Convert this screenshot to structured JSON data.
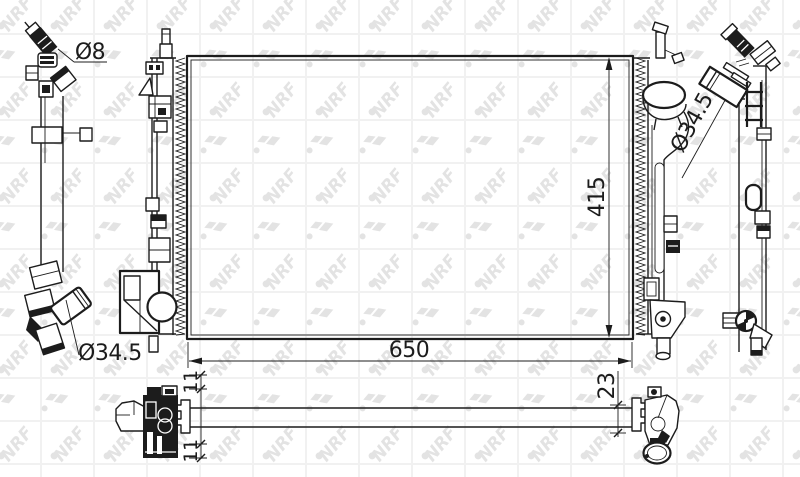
{
  "watermark": {
    "text": "NRF"
  },
  "colors": {
    "ink": "#1c1c1c",
    "watermark_letter": "#e3e3e3",
    "watermark_grid": "#f1f1f1",
    "paper": "#ffffff"
  },
  "dims": {
    "width": "650",
    "height": "415",
    "pipe_small": "Ø8",
    "outlet_left": "Ø34.5",
    "inlet_right": "Ø34.5",
    "offset_top": "11",
    "offset_bottom": "11",
    "depth": "23"
  }
}
